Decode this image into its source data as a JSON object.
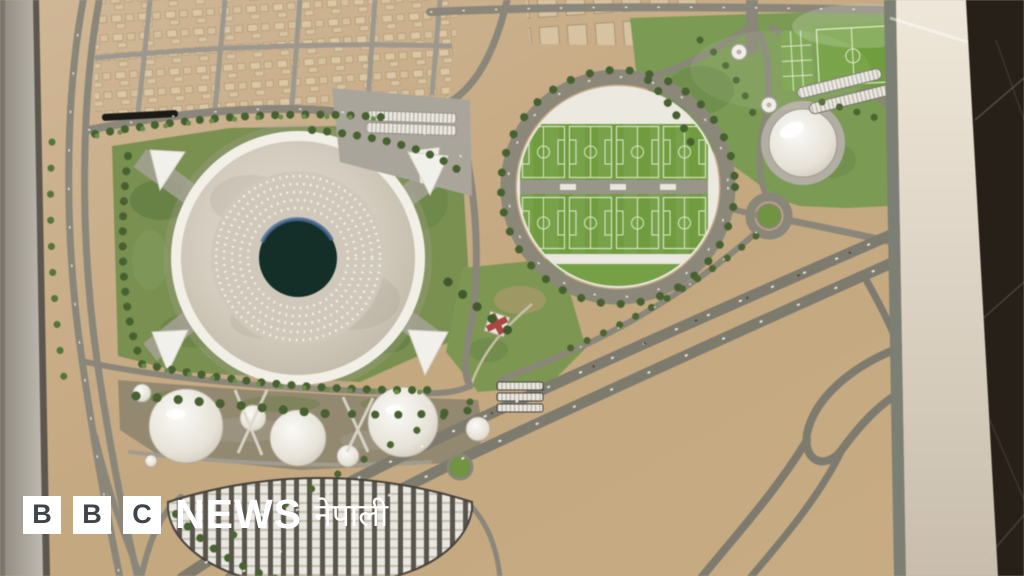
{
  "branding": {
    "blocks": [
      "B",
      "B",
      "C"
    ],
    "news_wordmark": "NEWS",
    "service_name": "नेपाली"
  },
  "scene": {
    "description": "Aerial photograph of an architectural scale model: large circular stadium with dark pitch oculus, circular training complex holding eight football pitches, small domed arena, white dome pavilions, fan-shaped parking rows, desert residential blocks and a sweeping highway interchange",
    "colors": {
      "desert_sand": "#c6a981",
      "road_grey": "#8a8679",
      "stadium_roof": "#d6cfc1",
      "stadium_oculus": "#132f28",
      "pitch_green": "#6f9c3d",
      "tree_green": "#46612f",
      "dome_white": "#efede7",
      "frame_dark": "#262019",
      "logo_white": "#ffffff",
      "logo_letter": "#3f434a"
    }
  }
}
